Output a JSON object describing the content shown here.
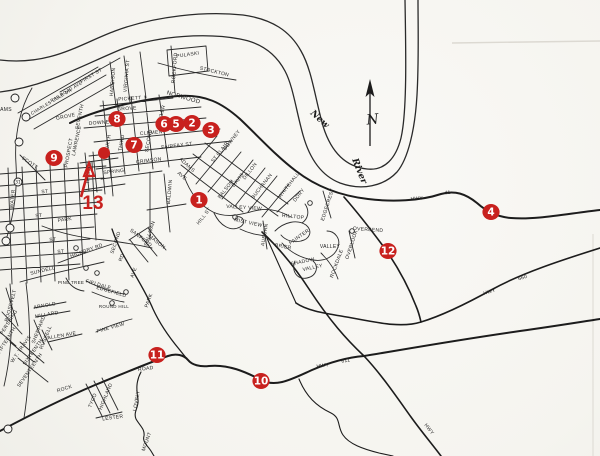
{
  "colors": {
    "marker_red": "#c8211e",
    "ink": "#1c1c1c",
    "paper": "#f7f6f2"
  },
  "compass": {
    "label": "N"
  },
  "river": {
    "word1": "New",
    "word2": "River"
  },
  "markers": [
    {
      "n": "1",
      "x": 199,
      "y": 200
    },
    {
      "n": "2",
      "x": 192,
      "y": 123
    },
    {
      "n": "3",
      "x": 211,
      "y": 130
    },
    {
      "n": "4",
      "x": 491,
      "y": 212
    },
    {
      "n": "5",
      "x": 176,
      "y": 124
    },
    {
      "n": "6",
      "x": 164,
      "y": 124
    },
    {
      "n": "7",
      "x": 134,
      "y": 145
    },
    {
      "n": "8",
      "x": 117,
      "y": 119
    },
    {
      "n": "9",
      "x": 54,
      "y": 158
    },
    {
      "n": "10",
      "x": 261,
      "y": 381
    },
    {
      "n": "11",
      "x": 157,
      "y": 355
    },
    {
      "n": "12",
      "x": 388,
      "y": 251
    }
  ],
  "marker13": {
    "label": "13",
    "x": 93,
    "y": 209,
    "arrow": {
      "x1": 81,
      "y1": 197,
      "x2": 89,
      "y2": 168
    },
    "dot_x": 104,
    "dot_y": 153,
    "dot_r": 6
  },
  "circled_symbols": [
    {
      "n": "31",
      "x": 18,
      "y": 182
    },
    {
      "n": "",
      "x": 15,
      "y": 98
    },
    {
      "n": "",
      "x": 26,
      "y": 117
    },
    {
      "n": "",
      "x": 19,
      "y": 142
    },
    {
      "n": "",
      "x": 10,
      "y": 228
    },
    {
      "n": "",
      "x": 6,
      "y": 241
    },
    {
      "n": "",
      "x": 8,
      "y": 429
    }
  ],
  "street_labels": [
    {
      "t": "PULASKI",
      "x": 188,
      "y": 56,
      "r": -8
    },
    {
      "t": "STOCKTON",
      "x": 214,
      "y": 73,
      "r": 14
    },
    {
      "t": "ROCKFORD",
      "x": 176,
      "y": 68,
      "r": -85
    },
    {
      "t": "NORWOOD",
      "x": 183,
      "y": 99,
      "r": 16,
      "s": 6
    },
    {
      "t": "VIRGINIA ST",
      "x": 128,
      "y": 76,
      "r": -85
    },
    {
      "t": "HARRISON",
      "x": 114,
      "y": 82,
      "r": -85
    },
    {
      "t": "PICKETT",
      "x": 130,
      "y": 100,
      "r": -4
    },
    {
      "t": "GROVE",
      "x": 127,
      "y": 110,
      "r": -4
    },
    {
      "t": "DOWNEY",
      "x": 101,
      "y": 124,
      "r": -4
    },
    {
      "t": "CLEMENT",
      "x": 153,
      "y": 134,
      "r": -5
    },
    {
      "t": "FAIRFAX ST",
      "x": 177,
      "y": 147,
      "r": -7
    },
    {
      "t": "CRIMSON",
      "x": 149,
      "y": 162,
      "r": -7
    },
    {
      "t": "SPRING",
      "x": 114,
      "y": 173,
      "r": -7
    },
    {
      "t": "TYLER",
      "x": 163,
      "y": 114,
      "r": -75
    },
    {
      "t": "SECOND",
      "x": 150,
      "y": 141,
      "r": -80
    },
    {
      "t": "THIRD",
      "x": 123,
      "y": 143,
      "r": -80
    },
    {
      "t": "FOURTH",
      "x": 109,
      "y": 146,
      "r": -80
    },
    {
      "t": "THISTLE",
      "x": 90,
      "y": 173,
      "r": -85
    },
    {
      "t": "BALDWIN",
      "x": 171,
      "y": 192,
      "r": -85
    },
    {
      "t": "SULLIVAN",
      "x": 151,
      "y": 234,
      "r": -72
    },
    {
      "t": "SANFORD",
      "x": 140,
      "y": 239,
      "r": 38
    },
    {
      "t": "MASON",
      "x": 156,
      "y": 243,
      "r": 38
    },
    {
      "t": "ADAMS",
      "x": 186,
      "y": 166,
      "r": 42
    },
    {
      "t": "AVE",
      "x": 181,
      "y": 177,
      "r": 42
    },
    {
      "t": "DOWNEY",
      "x": 233,
      "y": 141,
      "r": -52
    },
    {
      "t": "ST CLAIR",
      "x": 221,
      "y": 153,
      "r": -52
    },
    {
      "t": "DAVIS",
      "x": 239,
      "y": 181,
      "r": -52
    },
    {
      "t": "BALSOM",
      "x": 227,
      "y": 190,
      "r": -52
    },
    {
      "t": "DILLON",
      "x": 251,
      "y": 172,
      "r": -52
    },
    {
      "t": "BUCHANAN",
      "x": 263,
      "y": 187,
      "r": -52
    },
    {
      "t": "WHITEHALL",
      "x": 290,
      "y": 186,
      "r": -52
    },
    {
      "t": "DORY",
      "x": 300,
      "y": 196,
      "r": -52
    },
    {
      "t": "HILL ST",
      "x": 205,
      "y": 217,
      "r": -52
    },
    {
      "t": "VALLEY VIEW",
      "x": 244,
      "y": 209,
      "r": 4
    },
    {
      "t": "MIST VIEW",
      "x": 248,
      "y": 224,
      "r": 12
    },
    {
      "t": "AUBURN",
      "x": 266,
      "y": 235,
      "r": -80
    },
    {
      "t": "HILLTOP",
      "x": 293,
      "y": 218,
      "r": 6
    },
    {
      "t": "PAINTER",
      "x": 300,
      "y": 238,
      "r": -35
    },
    {
      "t": "VALLEY",
      "x": 330,
      "y": 248,
      "r": 0
    },
    {
      "t": "BRIER",
      "x": 283,
      "y": 248,
      "r": 10
    },
    {
      "t": "SHADOW",
      "x": 303,
      "y": 263,
      "r": -12
    },
    {
      "t": "VALLEY",
      "x": 313,
      "y": 269,
      "r": -12
    },
    {
      "t": "ROCKDALE",
      "x": 338,
      "y": 264,
      "r": -70
    },
    {
      "t": "OVERLOOK",
      "x": 353,
      "y": 245,
      "r": -72
    },
    {
      "t": "EDGECREST",
      "x": 329,
      "y": 205,
      "r": -72
    },
    {
      "t": "OVERBEND",
      "x": 368,
      "y": 231,
      "r": 4
    },
    {
      "t": "CHARLES COLE DR",
      "x": 52,
      "y": 103,
      "r": -31,
      "s": 4.5
    },
    {
      "t": "RAILROAD AVE",
      "x": 67,
      "y": 93,
      "r": -31,
      "s": 4.5
    },
    {
      "t": "FIRST ST",
      "x": 92,
      "y": 77,
      "r": -31
    },
    {
      "t": "GROVE",
      "x": 66,
      "y": 118,
      "r": -12
    },
    {
      "t": "SEVENTH",
      "x": 81,
      "y": 117,
      "r": -78
    },
    {
      "t": "LAWRENCE",
      "x": 78,
      "y": 141,
      "r": -78
    },
    {
      "t": "PROSPECT",
      "x": 70,
      "y": 153,
      "r": -80
    },
    {
      "t": "SCOTT",
      "x": 29,
      "y": 164,
      "r": 35
    },
    {
      "t": "AMS",
      "x": 6,
      "y": 111,
      "r": 0
    },
    {
      "t": "WATER",
      "x": 14,
      "y": 199,
      "r": -85
    },
    {
      "t": "PARK",
      "x": 65,
      "y": 221,
      "r": -8
    },
    {
      "t": "ST",
      "x": 45,
      "y": 193,
      "r": -6
    },
    {
      "t": "ST",
      "x": 39,
      "y": 217,
      "r": -6
    },
    {
      "t": "ST",
      "x": 53,
      "y": 241,
      "r": -6
    },
    {
      "t": "ST",
      "x": 61,
      "y": 253,
      "r": -6
    },
    {
      "t": "SUNDELL",
      "x": 43,
      "y": 272,
      "r": -14
    },
    {
      "t": "HICKORY RD",
      "x": 87,
      "y": 252,
      "r": -20
    },
    {
      "t": "PINE TREE",
      "x": 71,
      "y": 284,
      "r": 0,
      "s": 4.5
    },
    {
      "t": "FIELDALE",
      "x": 98,
      "y": 286,
      "r": 16
    },
    {
      "t": "EDGEFIELD",
      "x": 111,
      "y": 293,
      "r": 16
    },
    {
      "t": "ROUND HILL",
      "x": 114,
      "y": 308,
      "r": 0,
      "s": 4.5
    },
    {
      "t": "PINE VIEW",
      "x": 111,
      "y": 329,
      "r": -16
    },
    {
      "t": "ROOSEVELT",
      "x": 12,
      "y": 306,
      "r": -75
    },
    {
      "t": "PERSHING",
      "x": 10,
      "y": 323,
      "r": -58
    },
    {
      "t": "ARNOLD",
      "x": 45,
      "y": 307,
      "r": -10
    },
    {
      "t": "MILLARD",
      "x": 47,
      "y": 316,
      "r": -10
    },
    {
      "t": "SHEPPARD",
      "x": 40,
      "y": 330,
      "r": -68
    },
    {
      "t": "RUSSELL",
      "x": 47,
      "y": 338,
      "r": -68
    },
    {
      "t": "ALLEN AVE",
      "x": 62,
      "y": 337,
      "r": -10
    },
    {
      "t": "FIFTEENTH",
      "x": 8,
      "y": 341,
      "r": -58
    },
    {
      "t": "W.T. TRAVIS",
      "x": 22,
      "y": 350,
      "r": -55
    },
    {
      "t": "SIXTEENTH",
      "x": 34,
      "y": 353,
      "r": -55
    },
    {
      "t": "SEVENTEENTH",
      "x": 31,
      "y": 371,
      "r": -55
    },
    {
      "t": "SECOND",
      "x": 117,
      "y": 243,
      "r": -72
    },
    {
      "t": "RD",
      "x": 123,
      "y": 258,
      "r": -70
    },
    {
      "t": "AVE",
      "x": 135,
      "y": 273,
      "r": -70
    },
    {
      "t": "PARK",
      "x": 150,
      "y": 301,
      "r": -70
    },
    {
      "t": "ROCK",
      "x": 65,
      "y": 390,
      "r": -18
    },
    {
      "t": "ROAD",
      "x": 146,
      "y": 370,
      "r": -8
    },
    {
      "t": "TYCO",
      "x": 94,
      "y": 401,
      "r": -68
    },
    {
      "t": "HIGHLAND",
      "x": 107,
      "y": 397,
      "r": -68
    },
    {
      "t": "LESTER",
      "x": 113,
      "y": 419,
      "r": -8
    },
    {
      "t": "LOVELY",
      "x": 138,
      "y": 401,
      "r": -80
    },
    {
      "t": "MOUNT",
      "x": 148,
      "y": 442,
      "r": -70
    },
    {
      "t": "HWY",
      "x": 417,
      "y": 200,
      "r": -5
    },
    {
      "t": "11",
      "x": 448,
      "y": 194,
      "r": -5
    },
    {
      "t": "HWY",
      "x": 323,
      "y": 367,
      "r": -9
    },
    {
      "t": "611",
      "x": 346,
      "y": 362,
      "r": -9
    },
    {
      "t": "HWY",
      "x": 490,
      "y": 293,
      "r": -17
    },
    {
      "t": "660",
      "x": 523,
      "y": 279,
      "r": -17
    },
    {
      "t": "HWY",
      "x": 428,
      "y": 430,
      "r": 52
    }
  ]
}
